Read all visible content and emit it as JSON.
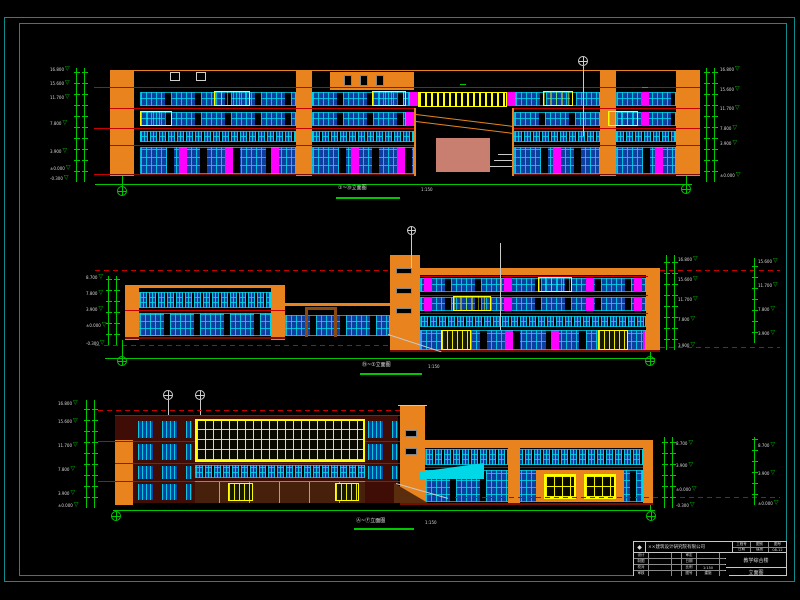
{
  "palette": {
    "background": "#000000",
    "wall_orange": "#e8831e",
    "window_cyan": "#00d8e8",
    "window_blue": "#0d3fa0",
    "accent_magenta": "#ff00ff",
    "highlight_yellow": "#ffff00",
    "floor_line_red": "#c80000",
    "dimension_green": "#00c800",
    "sheet_border_teal": "#0f8b8d",
    "auditorium_salmon": "#c97f6f",
    "wall_maroon": "#3f0c06",
    "storefront_brown": "#46200a",
    "annotation_white": "#d8d8d8"
  },
  "drawings": {
    "top": {
      "label": "①~⑲立面图",
      "scale": "1:150",
      "levels_left": [
        "16.800",
        "15.600",
        "11.700",
        "7.800",
        "3.900",
        "±0.000",
        "-0.300"
      ],
      "levels_right": [
        "16.800",
        "15.600",
        "11.700",
        "7.800",
        "3.900",
        "±0.000"
      ]
    },
    "middle": {
      "label": "⑲~①立面图",
      "scale": "1:150",
      "levels_left": [
        "8.700",
        "7.800",
        "3.900",
        "±0.000",
        "-0.300"
      ],
      "levels_right": [
        "16.800",
        "15.600",
        "11.700",
        "7.800",
        "3.900"
      ],
      "levels_far_right": [
        "15.600",
        "11.700",
        "7.800",
        "3.900"
      ]
    },
    "bottom": {
      "label": "Ⓐ~Ⓕ立面图",
      "scale": "1:150",
      "levels_left": [
        "16.800",
        "15.600",
        "11.700",
        "7.800",
        "3.900",
        "±0.000"
      ],
      "levels_right": [
        "8.700",
        "3.900",
        "±0.000",
        "-0.300"
      ],
      "levels_far_right": [
        "8.700",
        "3.900",
        "±0.000"
      ]
    }
  },
  "title_block": {
    "logo_glyph": "◆",
    "company": "××建筑设计研究院有限公司",
    "top_fields": [
      "工程号",
      "图别",
      "图号",
      "日期",
      "建施",
      "08-12"
    ],
    "grid": [
      "设计",
      "",
      "",
      "审定",
      "",
      "",
      "制图",
      "",
      "",
      "日期",
      "",
      "",
      "校对",
      "",
      "",
      "比例",
      "1:150",
      "",
      "审核",
      "",
      "",
      "图号",
      "建施",
      ""
    ],
    "project": "教学综合楼",
    "drawing_title": "立面图"
  }
}
